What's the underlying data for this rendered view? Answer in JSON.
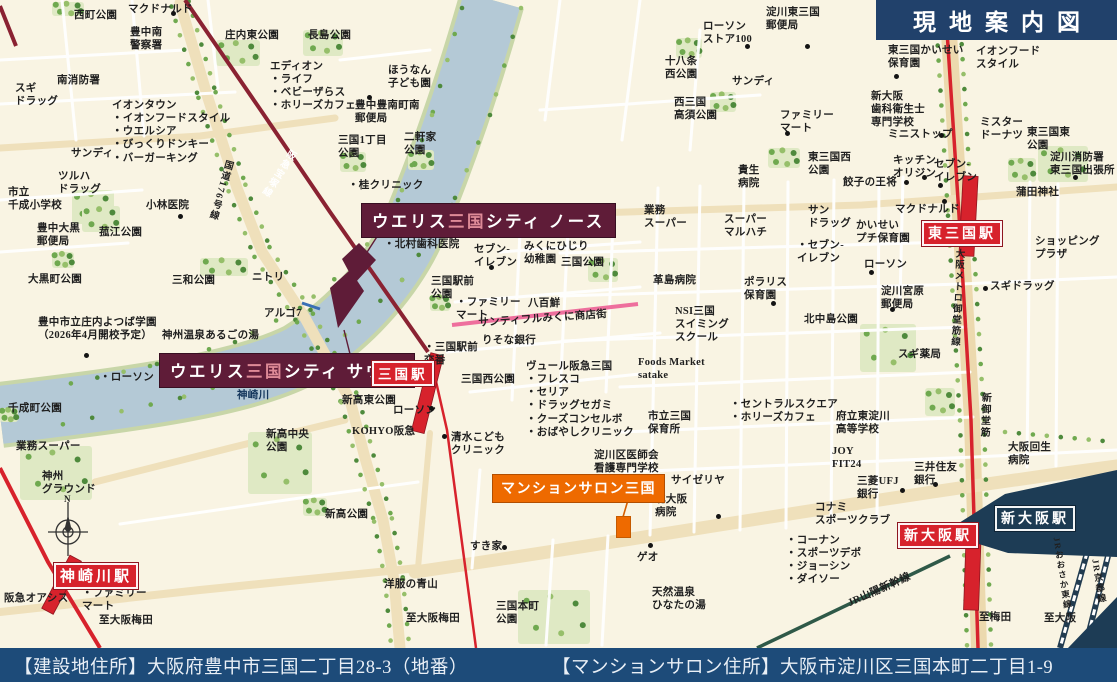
{
  "title": "現地案内図",
  "footer": {
    "left": "【建設地住所】大阪府豊中市三国二丁目28-3（地番）",
    "right": "【マンションサロン住所】大阪市淀川区三国本町二丁目1-9"
  },
  "project": {
    "north": {
      "pre": "ウエリス",
      "mid": "三国",
      "post": "シティ ノース"
    },
    "south": {
      "pre": "ウエリス",
      "mid": "三国",
      "post": "シティ サウス"
    },
    "salon": "マンションサロン三国"
  },
  "stations": {
    "mikuni": "三国駅",
    "kanzakigawa": "神崎川駅",
    "higashimikuni": "東三国駅",
    "shinosaka_red": "新大阪駅",
    "shinosaka_navy": "新大阪駅"
  },
  "colors": {
    "accent_red": "#d7222c",
    "hankyu_maroon": "#8a2232",
    "site_maroon": "#5f1c38",
    "navy": "#1d3c55",
    "footer_blue": "#1d4b79",
    "title_navy": "#21416b",
    "orange": "#ee6a00",
    "pink": "#ee6f9d",
    "water": "#b4c9d6"
  },
  "map": {
    "labels": [
      {
        "t": "マクドナルド",
        "x": 128,
        "y": 3
      },
      {
        "t": "西町公園",
        "x": 74,
        "y": 9
      },
      {
        "t": "豊中南\n警察署",
        "x": 130,
        "y": 26
      },
      {
        "t": "庄内東公園",
        "x": 225,
        "y": 29
      },
      {
        "t": "長島公園",
        "x": 308,
        "y": 29
      },
      {
        "t": "エディオン\n・ライフ\n・ベビーザらス\n・ホリーズカフェ",
        "x": 270,
        "y": 60
      },
      {
        "t": "スギ\nドラッグ",
        "x": 15,
        "y": 82
      },
      {
        "t": "南消防署",
        "x": 57,
        "y": 74
      },
      {
        "t": "イオンタウン\n・イオンフードスタイル\n・ウエルシア\n・びっくりドンキー\n・バーガーキング",
        "x": 112,
        "y": 99
      },
      {
        "t": "サンディ",
        "x": 71,
        "y": 147
      },
      {
        "t": "ツルハ\nドラッグ",
        "x": 58,
        "y": 170
      },
      {
        "t": "市立\n千成小学校",
        "x": 8,
        "y": 186
      },
      {
        "t": "小林医院",
        "x": 146,
        "y": 199
      },
      {
        "t": "国道176号線",
        "x": 222,
        "y": 158,
        "v": 1,
        "r": 16,
        "fs": 9.5
      },
      {
        "t": "阪急宝塚線",
        "x": 287,
        "y": 146,
        "v": 1,
        "r": 33,
        "c": "w",
        "fs": 9.5
      },
      {
        "t": "ほうなん\n子ども園",
        "x": 388,
        "y": 64
      },
      {
        "t": "豊中豊南町南\n郵便局",
        "x": 355,
        "y": 99
      },
      {
        "t": "三国1丁目\n公園",
        "x": 338,
        "y": 134
      },
      {
        "t": "二軒家\n公園",
        "x": 404,
        "y": 131
      },
      {
        "t": "・桂クリニック",
        "x": 348,
        "y": 179
      },
      {
        "t": "豊中大黒\n郵便局",
        "x": 37,
        "y": 222
      },
      {
        "t": "菰江公園",
        "x": 99,
        "y": 226
      },
      {
        "t": "大黒町公園",
        "x": 28,
        "y": 273
      },
      {
        "t": "三和公園",
        "x": 172,
        "y": 274
      },
      {
        "t": "ニトリ",
        "x": 252,
        "y": 271
      },
      {
        "t": "アルゴ7",
        "x": 264,
        "y": 307
      },
      {
        "t": "豊中市立庄内よつば学園\n（2026年4月開校予定）",
        "x": 38,
        "y": 316
      },
      {
        "t": "神州温泉あるごの湯",
        "x": 162,
        "y": 329
      },
      {
        "t": "・ローソン",
        "x": 100,
        "y": 371
      },
      {
        "t": "千成町公園",
        "x": 8,
        "y": 402
      },
      {
        "t": "神崎川",
        "x": 237,
        "y": 389,
        "c": "navy"
      },
      {
        "t": "業務スーパー",
        "x": 16,
        "y": 440
      },
      {
        "t": "神州\nグラウンド",
        "x": 42,
        "y": 470
      },
      {
        "t": "N",
        "x": 64,
        "y": 494,
        "fs": 9
      },
      {
        "t": "阪急オアシス",
        "x": 4,
        "y": 592
      },
      {
        "t": "・ファミリー\n マート",
        "x": 82,
        "y": 587
      },
      {
        "t": "至大阪梅田",
        "x": 99,
        "y": 614
      },
      {
        "t": "・北村歯科医院",
        "x": 384,
        "y": 238
      },
      {
        "t": "セブン-\nイレブン",
        "x": 474,
        "y": 243
      },
      {
        "t": "みくにひじり\n幼稚園",
        "x": 524,
        "y": 240
      },
      {
        "t": "三国公園",
        "x": 561,
        "y": 256
      },
      {
        "t": "三国駅前\n公園",
        "x": 431,
        "y": 275
      },
      {
        "t": "・ファミリー\n マート",
        "x": 456,
        "y": 296
      },
      {
        "t": "八百鮮",
        "x": 528,
        "y": 297
      },
      {
        "t": "サンティフルみくに商店街",
        "x": 478,
        "y": 317,
        "r": -4
      },
      {
        "t": "・三国駅前\n 交番",
        "x": 424,
        "y": 341
      },
      {
        "t": "りそな銀行",
        "x": 482,
        "y": 334
      },
      {
        "t": "三国西公園",
        "x": 461,
        "y": 373
      },
      {
        "t": "ヴュール阪急三国\n・フレスコ\n・セリア\n・ドラッグセガミ\n・クーズコンセルボ\n・おばやしクリニック",
        "x": 526,
        "y": 360
      },
      {
        "t": "Foods Market\nsatake",
        "x": 638,
        "y": 356
      },
      {
        "t": "新高東公園",
        "x": 342,
        "y": 394
      },
      {
        "t": "ローソン",
        "x": 393,
        "y": 404
      },
      {
        "t": "KOHYO阪急",
        "x": 352,
        "y": 425
      },
      {
        "t": "清水こども\nクリニック",
        "x": 451,
        "y": 431
      },
      {
        "t": "新高中央\n公園",
        "x": 266,
        "y": 428
      },
      {
        "t": "新高公園",
        "x": 325,
        "y": 508
      },
      {
        "t": "洋服の青山",
        "x": 384,
        "y": 578
      },
      {
        "t": "至大阪梅田",
        "x": 406,
        "y": 612
      },
      {
        "t": "三国本町\n公園",
        "x": 496,
        "y": 600
      },
      {
        "t": "すき家",
        "x": 470,
        "y": 540
      },
      {
        "t": "ゲオ",
        "x": 637,
        "y": 551
      },
      {
        "t": "天然温泉\nひなたの湯",
        "x": 652,
        "y": 586
      },
      {
        "t": "淀川東三国\n郵便局",
        "x": 766,
        "y": 6
      },
      {
        "t": "ローソン\nストア100",
        "x": 703,
        "y": 20
      },
      {
        "t": "十八条\n西公園",
        "x": 665,
        "y": 55
      },
      {
        "t": "サンディ",
        "x": 732,
        "y": 75
      },
      {
        "t": "西三国\n高須公園",
        "x": 674,
        "y": 96
      },
      {
        "t": "ファミリー\nマート",
        "x": 780,
        "y": 109
      },
      {
        "t": "新大阪\n歯科衛生士\n専門学校",
        "x": 871,
        "y": 90
      },
      {
        "t": "ミニストップ",
        "x": 888,
        "y": 128
      },
      {
        "t": "東三国かいせい\n保育園",
        "x": 888,
        "y": 44
      },
      {
        "t": "イオンフード\nスタイル",
        "x": 976,
        "y": 45
      },
      {
        "t": "ミスター\nドーナツ",
        "x": 980,
        "y": 116
      },
      {
        "t": "東三国東\n公園",
        "x": 1027,
        "y": 126
      },
      {
        "t": "淀川消防署\n東三国出張所",
        "x": 1050,
        "y": 151
      },
      {
        "t": "蒲田神社",
        "x": 1016,
        "y": 186
      },
      {
        "t": "キッチン\nオリジン",
        "x": 893,
        "y": 154
      },
      {
        "t": "セブン-\nイレブン",
        "x": 934,
        "y": 158
      },
      {
        "t": "餃子の王将",
        "x": 843,
        "y": 176
      },
      {
        "t": "マクドナルド",
        "x": 895,
        "y": 203
      },
      {
        "t": "かいせい\nプチ保育園",
        "x": 856,
        "y": 219
      },
      {
        "t": "ローソン",
        "x": 864,
        "y": 258
      },
      {
        "t": "淀川宮原\n郵便局",
        "x": 881,
        "y": 285
      },
      {
        "t": "ショッピング\nプラザ",
        "x": 1035,
        "y": 235
      },
      {
        "t": "スギドラッグ",
        "x": 990,
        "y": 280
      },
      {
        "t": "業務\nスーパー",
        "x": 644,
        "y": 204
      },
      {
        "t": "スーパー\nマルハチ",
        "x": 724,
        "y": 213
      },
      {
        "t": "サン\nドラッグ",
        "x": 808,
        "y": 204
      },
      {
        "t": "・セブン-\n イレブン",
        "x": 797,
        "y": 239
      },
      {
        "t": "貴生\n病院",
        "x": 738,
        "y": 164
      },
      {
        "t": "東三国西\n公園",
        "x": 808,
        "y": 151
      },
      {
        "t": "革島病院",
        "x": 653,
        "y": 274
      },
      {
        "t": "ポラリス\n保育園",
        "x": 744,
        "y": 276
      },
      {
        "t": "NSI三国\nスイミング\nスクール",
        "x": 675,
        "y": 305
      },
      {
        "t": "北中島公園",
        "x": 804,
        "y": 313
      },
      {
        "t": "スギ薬局",
        "x": 898,
        "y": 348
      },
      {
        "t": "大阪メトロ御堂筋線",
        "x": 952,
        "y": 248,
        "v": 1,
        "r": 3,
        "fs": 9.5
      },
      {
        "t": "新御堂筋",
        "x": 978,
        "y": 392,
        "v": 1,
        "r": 2,
        "fs": 10
      },
      {
        "t": "・セントラルスクエア\n・ホリーズカフェ",
        "x": 730,
        "y": 398
      },
      {
        "t": "市立三国\n保育所",
        "x": 648,
        "y": 410
      },
      {
        "t": "府立東淀川\n高等学校",
        "x": 836,
        "y": 410
      },
      {
        "t": "淀川区医師会\n看護専門学校",
        "x": 594,
        "y": 449
      },
      {
        "t": "JOY\nFIT24",
        "x": 832,
        "y": 445
      },
      {
        "t": "三井住友\n銀行",
        "x": 914,
        "y": 461
      },
      {
        "t": "三菱UFJ\n銀行",
        "x": 857,
        "y": 475
      },
      {
        "t": "サイゼリヤ",
        "x": 671,
        "y": 474
      },
      {
        "t": "北大阪\n病院",
        "x": 655,
        "y": 493
      },
      {
        "t": "コナミ\nスポーツクラブ",
        "x": 815,
        "y": 501
      },
      {
        "t": "大阪回生\n病院",
        "x": 1008,
        "y": 441
      },
      {
        "t": "・コーナン\n・スポーツデポ\n・ジョーシン\n・ダイソー",
        "x": 786,
        "y": 534
      },
      {
        "t": "JR山陽新幹線",
        "x": 846,
        "y": 598,
        "r": -24
      },
      {
        "t": "至梅田",
        "x": 979,
        "y": 611
      },
      {
        "t": "至大阪",
        "x": 1044,
        "y": 612
      },
      {
        "t": "JRおおさか東線",
        "x": 1051,
        "y": 538,
        "v": 1,
        "r": -9,
        "fs": 8.5
      },
      {
        "t": "JR京都線",
        "x": 1089,
        "y": 560,
        "v": 1,
        "r": -9,
        "fs": 9
      }
    ],
    "dots": [
      [
        173,
        13
      ],
      [
        180,
        216
      ],
      [
        86,
        355
      ],
      [
        504,
        547
      ],
      [
        650,
        545
      ],
      [
        491,
        267
      ],
      [
        444,
        436
      ],
      [
        431,
        408
      ],
      [
        747,
        46
      ],
      [
        807,
        46
      ],
      [
        787,
        133
      ],
      [
        941,
        135
      ],
      [
        896,
        76
      ],
      [
        924,
        177
      ],
      [
        940,
        185
      ],
      [
        906,
        182
      ],
      [
        944,
        201
      ],
      [
        1075,
        177
      ],
      [
        871,
        272
      ],
      [
        892,
        309
      ],
      [
        985,
        288
      ],
      [
        773,
        303
      ],
      [
        718,
        516
      ],
      [
        935,
        484
      ],
      [
        902,
        490
      ],
      [
        369,
        97
      ]
    ]
  }
}
